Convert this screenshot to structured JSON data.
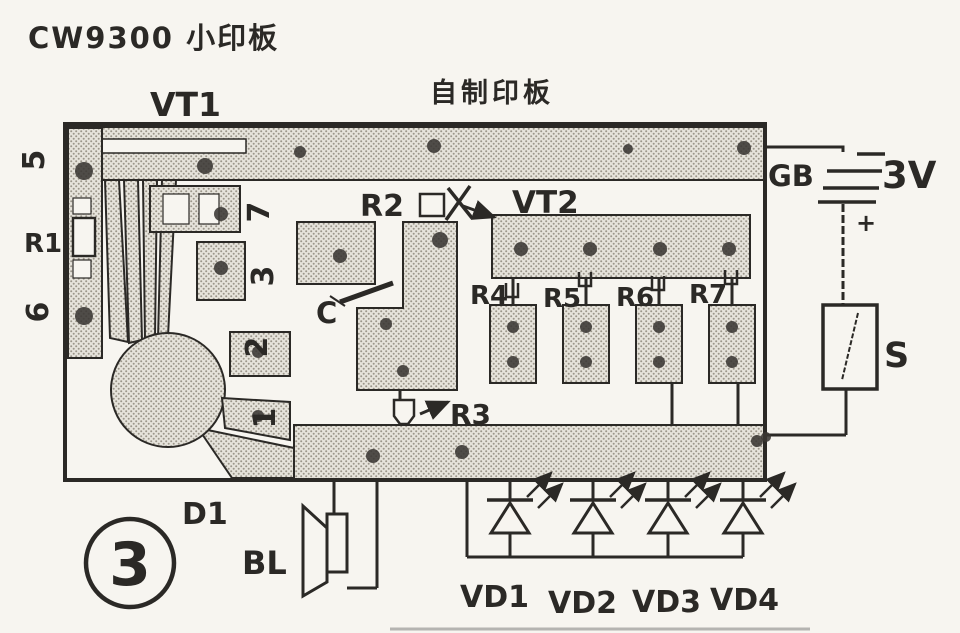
{
  "figure": {
    "title": "CW9300 小印板",
    "board_label": "自制印板",
    "number": "3"
  },
  "components": {
    "vt1": "VT1",
    "vt2": "VT2",
    "r1": "R1",
    "r2": "R2",
    "r3": "R3",
    "r4": "R4",
    "r5": "R5",
    "r6": "R6",
    "r7": "R7",
    "c": "C",
    "d1": "D1",
    "bl": "BL",
    "s": "S",
    "gb": "GB",
    "voltage": "3V",
    "plus": "+",
    "vd1": "VD1",
    "vd2": "VD2",
    "vd3": "VD3",
    "vd4": "VD4"
  },
  "pins": {
    "p5": "5",
    "p6": "6",
    "p7": "7",
    "p3": "3",
    "p2": "2",
    "p1": "1"
  },
  "colors": {
    "ink": "#2b2926",
    "paper": "#f7f5f0",
    "copper_base": "#e6e3db",
    "copper_dot": "#9b968a"
  }
}
